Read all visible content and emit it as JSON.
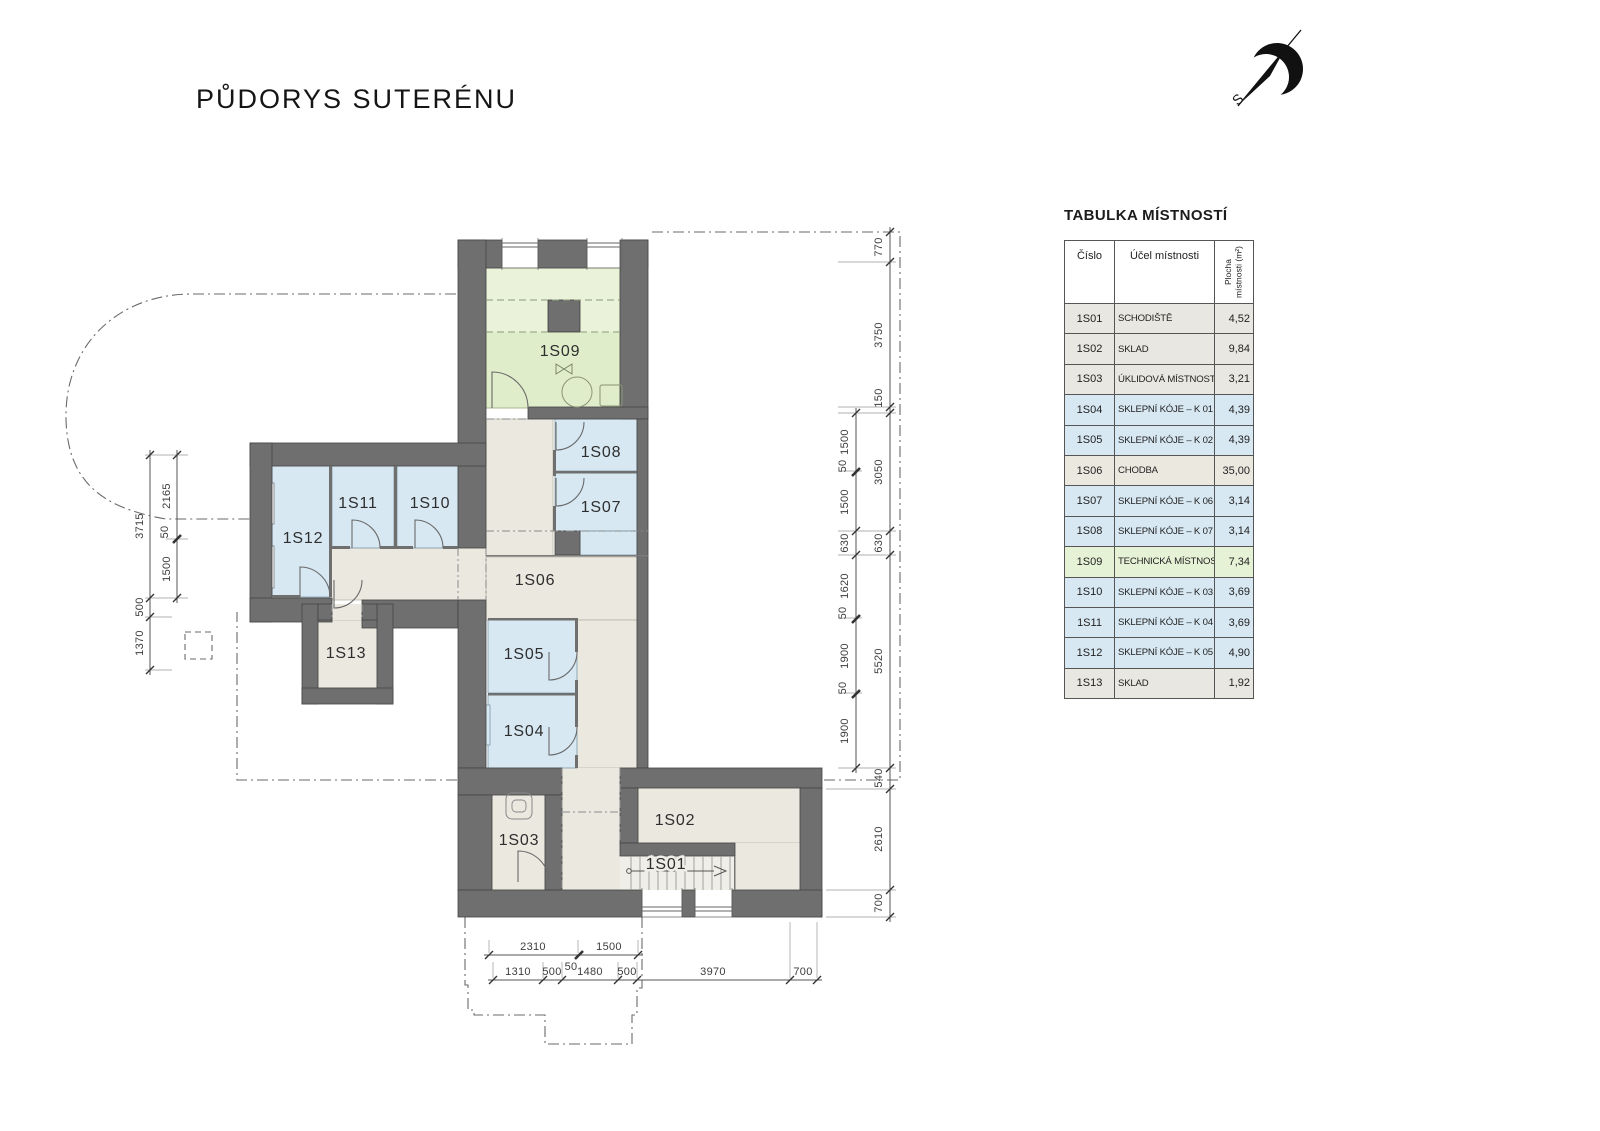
{
  "page": {
    "title": "PŮDORYS SUTERÉNU"
  },
  "north": {
    "label": "S"
  },
  "table": {
    "title": "TABULKA MÍSTNOSTÍ",
    "headers": {
      "no": "Číslo",
      "name": "Účel místnosti",
      "area": "Plocha místnosti (m²)"
    },
    "rows": [
      {
        "no": "1S01",
        "name": "SCHODIŠTĚ",
        "area": "4,52",
        "color": "gray"
      },
      {
        "no": "1S02",
        "name": "SKLAD",
        "area": "9,84",
        "color": "gray"
      },
      {
        "no": "1S03",
        "name": "ÚKLIDOVÁ MÍSTNOST",
        "area": "3,21",
        "color": "gray"
      },
      {
        "no": "1S04",
        "name": "SKLEPNÍ KÓJE – K 01",
        "area": "4,39",
        "color": "blue"
      },
      {
        "no": "1S05",
        "name": "SKLEPNÍ KÓJE – K 02",
        "area": "4,39",
        "color": "blue"
      },
      {
        "no": "1S06",
        "name": "CHODBA",
        "area": "35,00",
        "color": "beige"
      },
      {
        "no": "1S07",
        "name": "SKLEPNÍ KÓJE – K 06",
        "area": "3,14",
        "color": "blue"
      },
      {
        "no": "1S08",
        "name": "SKLEPNÍ KÓJE – K 07",
        "area": "3,14",
        "color": "blue"
      },
      {
        "no": "1S09",
        "name": "TECHNICKÁ MÍSTNOST",
        "area": "7,34",
        "color": "green"
      },
      {
        "no": "1S10",
        "name": "SKLEPNÍ KÓJE – K 03",
        "area": "3,69",
        "color": "blue"
      },
      {
        "no": "1S11",
        "name": "SKLEPNÍ KÓJE – K 04",
        "area": "3,69",
        "color": "blue"
      },
      {
        "no": "1S12",
        "name": "SKLEPNÍ KÓJE – K 05",
        "area": "4,90",
        "color": "blue"
      },
      {
        "no": "1S13",
        "name": "SKLAD",
        "area": "1,92",
        "color": "gray"
      }
    ]
  },
  "plan": {
    "room_labels": {
      "s01": "1S01",
      "s02": "1S02",
      "s03": "1S03",
      "s04": "1S04",
      "s05": "1S05",
      "s06": "1S06",
      "s07": "1S07",
      "s08": "1S08",
      "s09": "1S09",
      "s10": "1S10",
      "s11": "1S11",
      "s12": "1S12",
      "s13": "1S13"
    },
    "colors": {
      "wall": "#6f6f6f",
      "cellar_blue": "#d7e8f3",
      "corridor_beige": "#ebe8e0",
      "technical_green": "#e0edca",
      "storage_gray": "#e9e7e1"
    }
  },
  "dims": {
    "right_outer": [
      "770",
      "3750",
      "150",
      "3050",
      "630",
      "5520",
      "540",
      "2610",
      "700"
    ],
    "right_inner": [
      "1500",
      "50",
      "1500",
      "630",
      "1620",
      "50",
      "1900",
      "50",
      "1900"
    ],
    "left_outer": [
      "3715",
      "500",
      "1370"
    ],
    "left_inner": [
      "2165",
      "50",
      "1500"
    ],
    "bottom_row1": [
      "2310",
      "50",
      "1500"
    ],
    "bottom_row2": [
      "1310",
      "500",
      "1480",
      "500",
      "3970",
      "700"
    ]
  }
}
